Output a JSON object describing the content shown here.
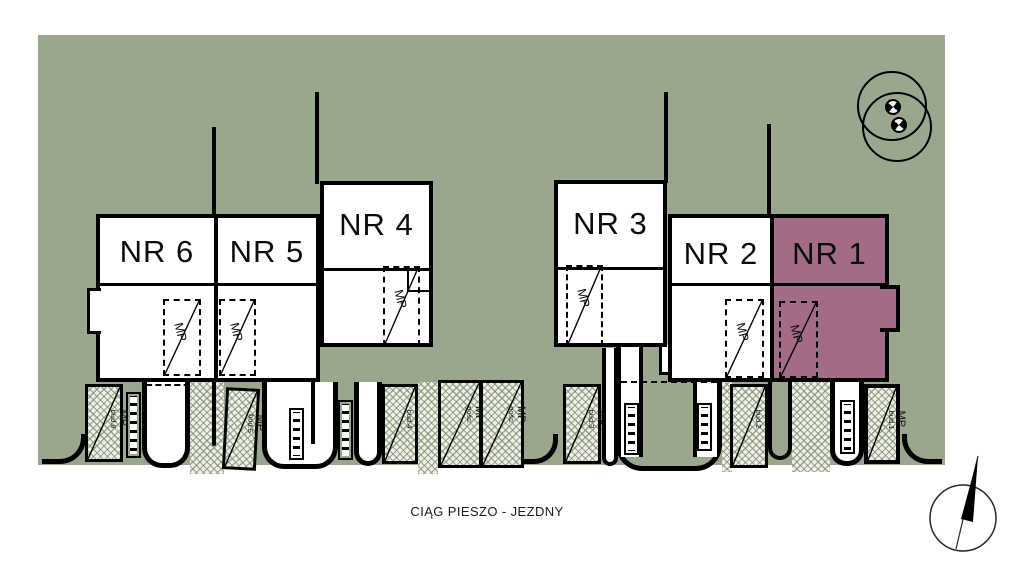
{
  "site": {
    "walkway_label": "CIĄG PIESZO - JEZDNY"
  },
  "buildings": [
    {
      "id": "nr6",
      "label": "NR 6",
      "highlighted": false
    },
    {
      "id": "nr5",
      "label": "NR 5",
      "highlighted": false
    },
    {
      "id": "nr4",
      "label": "NR 4",
      "highlighted": false
    },
    {
      "id": "nr3",
      "label": "NR 3",
      "highlighted": false
    },
    {
      "id": "nr2",
      "label": "NR 2",
      "highlighted": false
    },
    {
      "id": "nr1",
      "label": "NR 1",
      "highlighted": true
    }
  ],
  "parking": {
    "garage_spots": [
      {
        "label": "MP"
      },
      {
        "label": "MP"
      },
      {
        "label": "MP"
      },
      {
        "label": "MP"
      },
      {
        "label": "MP"
      },
      {
        "label": "MP"
      }
    ],
    "outdoor_spots": [
      {
        "label": "MP",
        "sublabel": "bud.6"
      },
      {
        "label": "MP",
        "sublabel": "bud.5"
      },
      {
        "label": "MP",
        "sublabel": "bud.4"
      },
      {
        "label": "MP",
        "sublabel": "gośc."
      },
      {
        "label": "MP",
        "sublabel": "gośc."
      },
      {
        "label": "MP",
        "sublabel": "bud.3"
      },
      {
        "label": "MP",
        "sublabel": "bud.2"
      },
      {
        "label": "MP",
        "sublabel": "bud.1"
      }
    ]
  },
  "icons": {
    "tree_icon": "two overlapping canopy circles with quadrant trunk markers",
    "north_arrow_icon": "compass circle with black needle"
  },
  "colors": {
    "background_green": "#9aa78f",
    "highlight_purple": "#a26c86",
    "line_black": "#000000",
    "hatch_base": "#eef0e7"
  }
}
